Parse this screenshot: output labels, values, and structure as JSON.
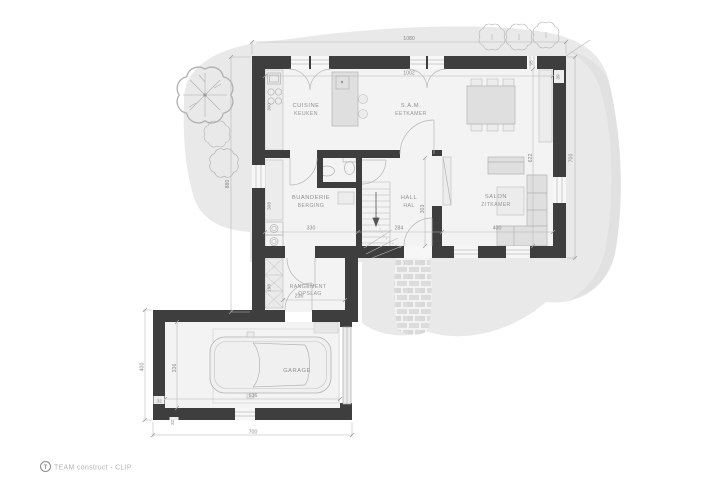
{
  "footer": {
    "brand": "TEAM construct - CLIP",
    "logo_letter": "T"
  },
  "rooms": {
    "cuisine": {
      "fr": "CUISINE",
      "nl": "KEUKEN"
    },
    "dining": {
      "fr": "S.À.M.",
      "nl": "EETKAMER"
    },
    "laundry": {
      "fr": "BUANDERIE",
      "nl": "BERGING"
    },
    "hall": {
      "fr": "HALL",
      "nl": "HAL"
    },
    "living": {
      "fr": "SALON",
      "nl": "ZITKAMER"
    },
    "storage": {
      "fr": "RANGEMENT",
      "nl": "OPSLAG"
    },
    "garage": {
      "fr": "GARAGE"
    }
  },
  "dims": {
    "overall_width": "1080",
    "interior_width": "1002",
    "overall_depth_left": "880",
    "overall_depth_right": "700",
    "wall_thickness": "39",
    "top_window": "95",
    "kitchen_counter": "300",
    "laundry_counter": "308",
    "laundry_width": "330",
    "hall_width": "284",
    "hall_depth": "303",
    "living_width": "400",
    "living_depth": "622",
    "storage_width": "236",
    "storage_depth": "198",
    "garage_inner_width": "636",
    "garage_inner_depth": "336",
    "garage_wall_left": "32",
    "garage_wall_bottom": "32",
    "garage_overall_width": "700",
    "garage_overall_depth": "400"
  },
  "colors": {
    "wall": "#3e3e3e",
    "floor": "#f3f3f3",
    "site": "#e9e9e9",
    "site_shade": "#dedede",
    "furniture": "#dfdfdf",
    "dimension_text": "#8a8a8a"
  }
}
